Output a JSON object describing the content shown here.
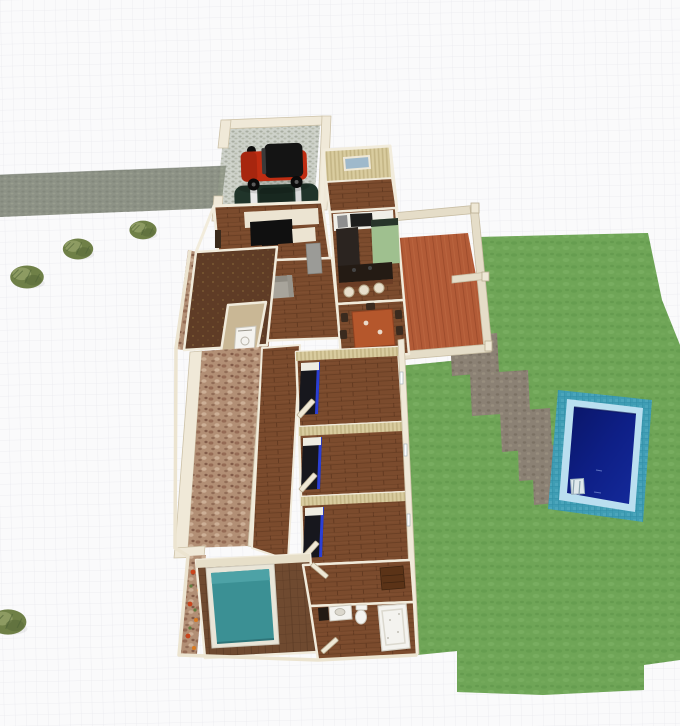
{
  "view": {
    "type": "3d-floor-plan-aerial-view",
    "zoom_level": "",
    "visible_text": ""
  },
  "colors": {
    "background": "#fafafb",
    "grid_line": "#eaeaef",
    "driveway": "#8d9286",
    "driveway_dark": "#7a8074",
    "gravel": "#99a18e",
    "bush_dark": "#6f8047",
    "bush_light": "#93a067",
    "grass": "#6fa557",
    "grass_dark": "#5f974a",
    "grass_light": "#82b569",
    "path_stone": "#8b8174",
    "path_stone_dark": "#6f655a",
    "pool_tile": "#3f9db4",
    "pool_tile_line": "#2f8aa3",
    "pool_coping": "#badff0",
    "pool_water": "#0e1f86",
    "pool_water_deep": "#0a1668",
    "deck": "#b25b37",
    "deck_dark": "#9a4a2a",
    "pergola": "#e5ddc8",
    "pergola_shadow": "#c7bca2",
    "wall": "#f0e9d8",
    "wall_shadow": "#cdc2a8",
    "wallpaper": "#d9cc9f",
    "wallpaper_stripe": "#c4b585",
    "window_glass": "#9fb9cb",
    "wood_floor": "#7b4b2d",
    "wood_floor_line": "#663c22",
    "tile_floor": "#6f4a30",
    "tile_floor_line": "#5a3a24",
    "study_floor": "#5f3c26",
    "porch_stone": "#b28f75",
    "laundry_floor": "#c9b795",
    "gold_mat": "#ad9348",
    "jeep_red": "#bf2d12",
    "jeep_top": "#141414",
    "car_green": "#20342a",
    "car_trim": "#e8e8e8",
    "bed_dark": "#17171d",
    "bed_blue": "#2b3fd4",
    "bed_pillow": "#efece2",
    "master_bed": "#3b9094",
    "bed_frame": "#e9e5d8",
    "sofa": "#a8a49b",
    "sofa_dark": "#8f8b82",
    "cabinet_gray": "#9b9b97",
    "table": "#b5572c",
    "chair": "#3a2a1e",
    "counter_white": "#f0efe8",
    "counter_dark": "#2b2420",
    "counter_brown": "#6b3d25",
    "fridge_green": "#9fc08f",
    "appliance_black": "#1d1d1d",
    "media_cream": "#ece4d2",
    "media_black": "#101010",
    "fixture_white": "#f4f3ef",
    "fixture_line": "#c9c5ba",
    "dresser": "#5b3317",
    "flower_red": "#c8441c",
    "flower_orange": "#d97a20",
    "flower_green": "#5f7d3f",
    "ladder": "#dfe8ec"
  },
  "objects": {
    "vehicles": [
      "red-jeep",
      "green-car"
    ],
    "outdoor": [
      "driveway",
      "carport",
      "deck-pergola",
      "lawn",
      "stone-path",
      "swimming-pool",
      "pool-ladder",
      "bushes",
      "flower-bed",
      "porch"
    ],
    "rooms": [
      "entry-room",
      "kitchen",
      "dining-room",
      "living-room",
      "media-room",
      "study",
      "laundry",
      "bedroom-1",
      "bedroom-2",
      "bedroom-3",
      "master-bedroom",
      "dressing-room",
      "bathroom"
    ],
    "furniture": [
      "media-unit",
      "sofa",
      "side-cabinet",
      "kitchen-counter",
      "fridge",
      "island-bar",
      "bar-stools",
      "dining-table",
      "dining-chairs",
      "washer",
      "bed-1",
      "bed-2",
      "bed-3",
      "master-bed",
      "dresser",
      "vanity",
      "toilet",
      "bathtub"
    ]
  }
}
